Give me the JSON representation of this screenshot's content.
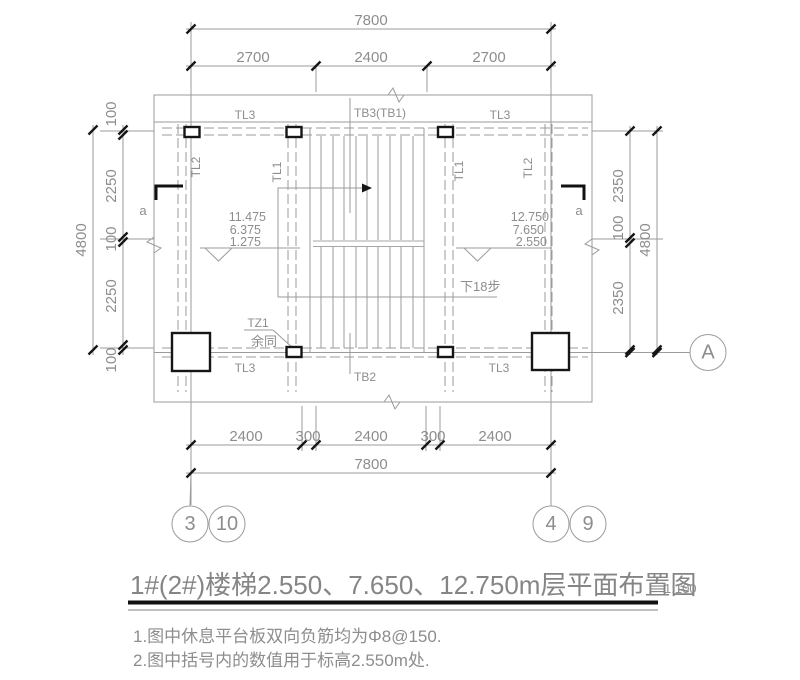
{
  "title_block": {
    "title": "1#(2#)楼梯2.550、7.650、12.750m层平面布置图",
    "scale": "1:100"
  },
  "notes": {
    "note1": "1.图中休息平台板双向负筋均为Φ8@150.",
    "note2": "2.图中括号内的数值用于标高2.550m处."
  },
  "dimensions": {
    "top": {
      "overall": "7800",
      "seg1": "2700",
      "seg2": "2400",
      "seg3": "2700"
    },
    "bottom": {
      "overall": "7800",
      "seg1": "2400",
      "seg2": "300",
      "seg3": "2400",
      "seg4": "300",
      "seg5": "2400"
    },
    "left": {
      "overall": "4800",
      "seg1": "100",
      "seg2": "2250",
      "seg3": "100",
      "seg4": "2250",
      "seg5": "100"
    },
    "right": {
      "overall": "4800",
      "seg1": "2350",
      "seg2": "100",
      "seg3": "2350"
    }
  },
  "grid": {
    "bubble_3": "3",
    "bubble_10": "10",
    "bubble_4": "4",
    "bubble_9": "9",
    "bubble_a": "A"
  },
  "beams": {
    "tl3": "TL3",
    "tl2": "TL2",
    "tl1": "TL1",
    "tb3": "TB3(TB1)",
    "tb2": "TB2"
  },
  "stair": {
    "down_note": "下18步",
    "column_label": "TZ1",
    "column_note": "余同"
  },
  "elevations": {
    "left1": "11.475",
    "left2": "6.375",
    "left3": "1.275",
    "right1": "12.750",
    "right2": "7.650",
    "right3": "2.550"
  },
  "section": {
    "mark": "a"
  },
  "colors": {
    "line": "#9b9b9b",
    "text": "#8d8d8d",
    "black": "#161616"
  }
}
